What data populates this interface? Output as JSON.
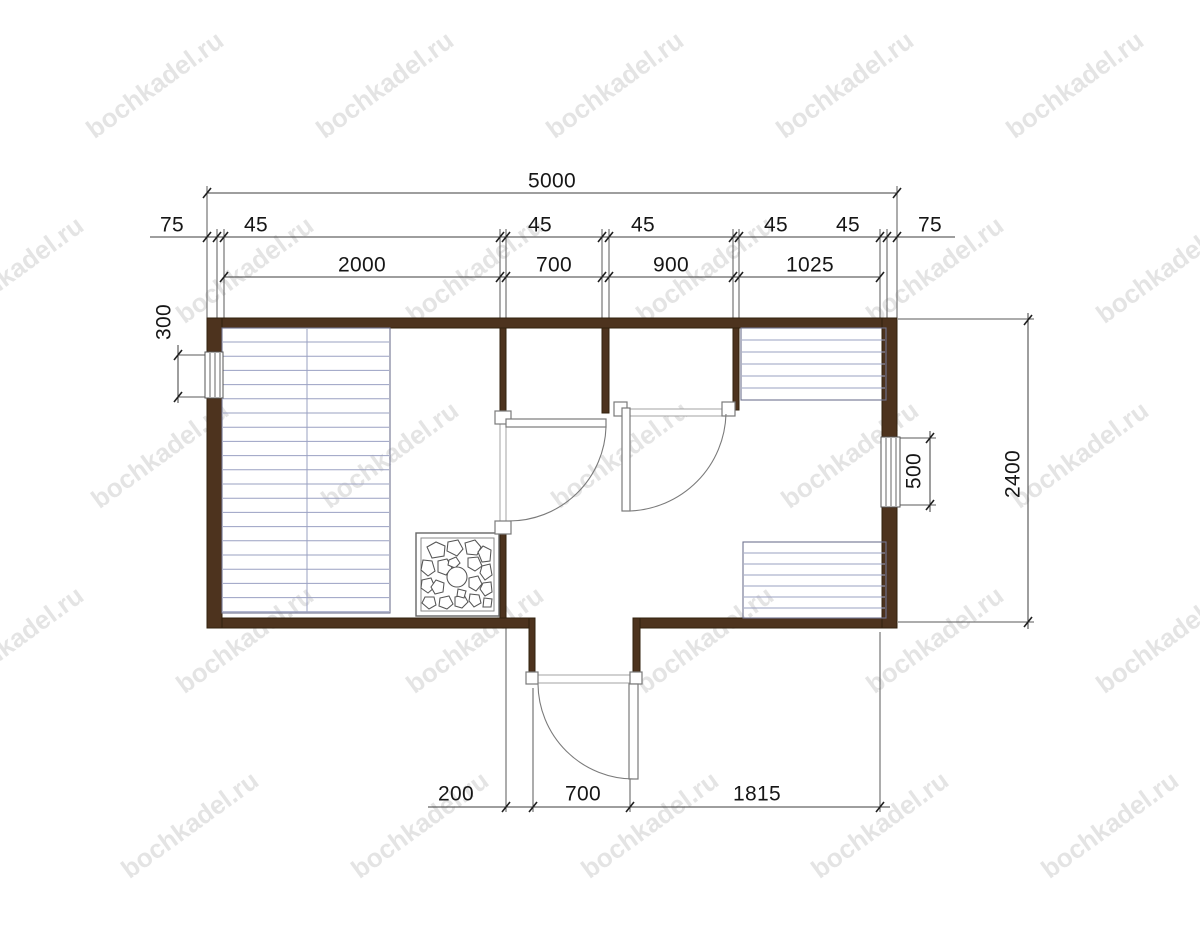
{
  "watermark": {
    "text": "bochkadel.ru"
  },
  "plan": {
    "type": "sauna-floor-plan",
    "units": "mm",
    "dims": {
      "top_overall": "5000",
      "top_walls": [
        "75",
        "45",
        "45",
        "45",
        "45",
        "45",
        "75"
      ],
      "top_rooms": [
        "2000",
        "700",
        "900",
        "1025"
      ],
      "bottom": [
        "200",
        "700",
        "1815"
      ],
      "left_window": "300",
      "right_window": "500",
      "right_overall": "2400"
    }
  }
}
